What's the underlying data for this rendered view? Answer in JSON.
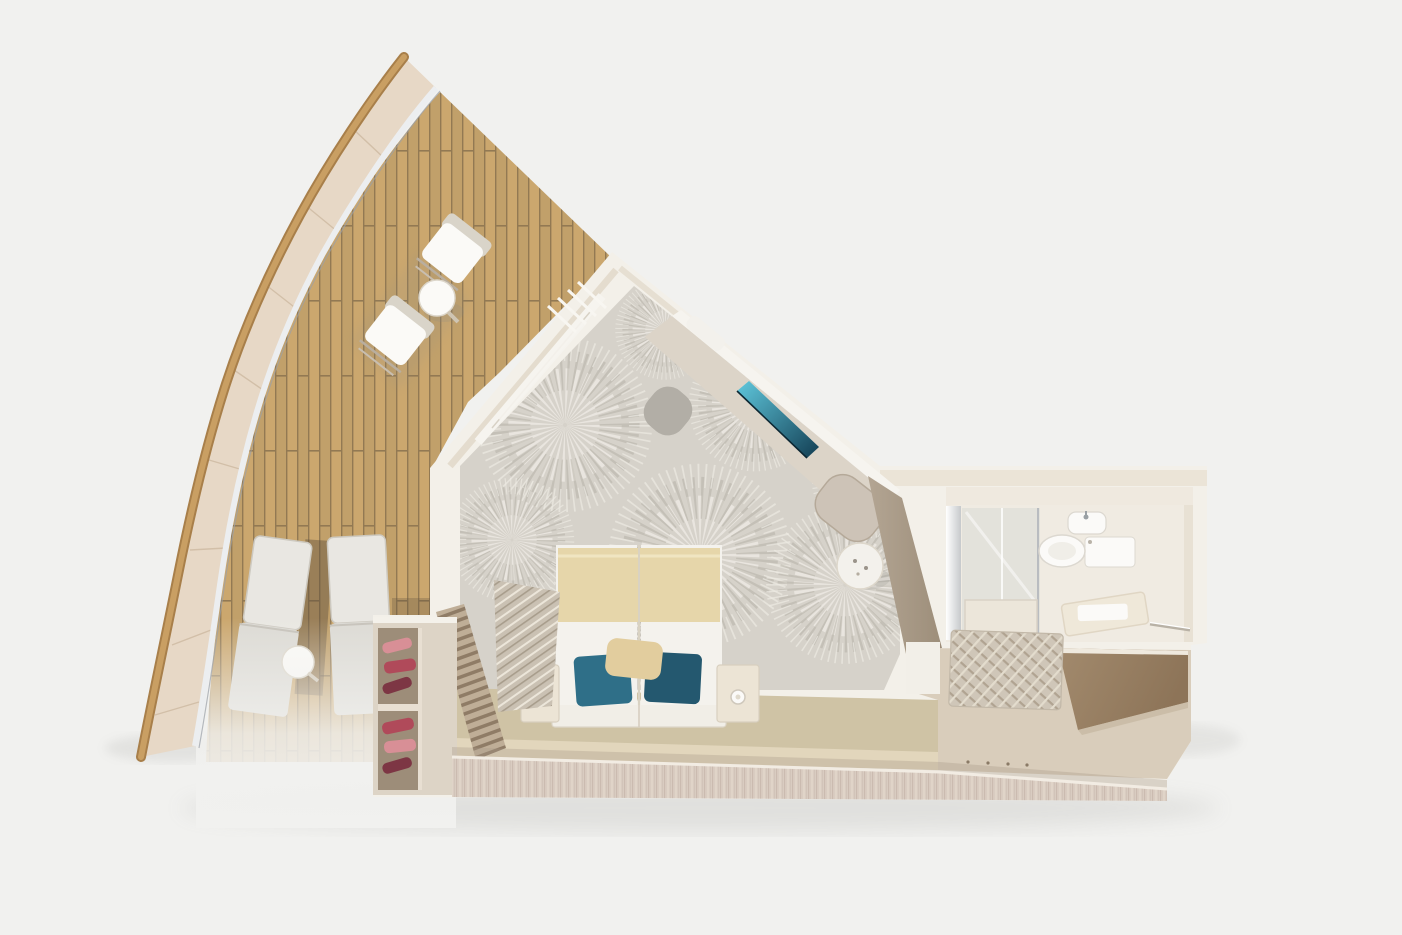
{
  "scene": {
    "type": "3d-cutaway-floor-plan-render",
    "subject": "cruise-ship-bow-suite-top-view",
    "areas": [
      {
        "name": "balcony",
        "objects": [
          "curved-hull",
          "glass-railing",
          "teak-deck",
          "deck-chair",
          "deck-chair",
          "round-table",
          "sun-lounger",
          "sun-lounger",
          "side-table"
        ]
      },
      {
        "name": "bedroom",
        "objects": [
          "patterned-carpet",
          "twin-beds",
          "teal-pillows",
          "nightstand-left",
          "nightstand-right",
          "table-lamps",
          "desk-console",
          "wall-tv",
          "desk-chair",
          "lounge-chair",
          "vanity-stool",
          "curtains",
          "balcony-door",
          "wardrobe-with-shoes",
          "louver-bench",
          "textured-wall"
        ]
      },
      {
        "name": "bathroom",
        "objects": [
          "shower-glass",
          "mirror",
          "toilet",
          "sink",
          "bath-mat",
          "towel-rail"
        ]
      },
      {
        "name": "corridor",
        "objects": [
          "entry-floor",
          "dark-entry-wall",
          "woven-rug",
          "floor-markers"
        ]
      }
    ]
  },
  "colors": {
    "background": "#f1f1ef",
    "shadow": "#8a8a86",
    "hull_rail": "#c99f63",
    "hull_rail_dark": "#a87f4a",
    "hull_band": "#e7d8c6",
    "hull_seam": "#cdb9a1",
    "railing": "#eceef0",
    "railing_edge": "#9aa0a8",
    "deck_plank": "#c7a164",
    "deck_gap": "#8a6f46",
    "wall_top": "#f3f0e9",
    "wall_face": "#ddd2c0",
    "taupe_wall": "#b3a593",
    "carpet_base": "#d6d2ca",
    "carpet_light": "#edeae3",
    "carpet_dark": "#b0aa9f",
    "blanket": "#e6d6aa",
    "duvet": "#f4f2ed",
    "pillow_teal": "#2f6f88",
    "pillow_teal_dark": "#24586f",
    "pillow_beige": "#e2cd9e",
    "headboard": "#f1eee7",
    "nightstand": "#ece4d5",
    "platform": "#cfc3a5",
    "platform_frame": "#e3d8bf",
    "bottom_wall": "#d9ccc1",
    "bottom_wall_grain": "#c3b3a7",
    "wardrobe": "#ddd4c6",
    "wardrobe_back": "#9d8d79",
    "shoe_red": "#b04a5a",
    "shoe_pink": "#d88f96",
    "shoe_dark": "#7d3644",
    "louver_light": "#bfae97",
    "louver_dark": "#8f7c66",
    "texture_wall": "#cac1b3",
    "desk": "#dcd4c8",
    "desk_edge": "#f6f4ef",
    "tv_teal": "#5fc8dd",
    "tv_dark": "#123d52",
    "chair_gray": "#b2aea6",
    "chair_beige": "#cdc3b7",
    "stool": "#f3f1ec",
    "bathroom_floor": "#f0ebe2",
    "bathroom_wall": "#efe9df",
    "glass": "#d9dad6",
    "fixture_white": "#fbfaf8",
    "fixture_line": "#d8d2c6",
    "corridor_floor": "#d9cdbb",
    "corridor_wall_dark": "#a28a6d",
    "corridor_wall_darker": "#8d7458",
    "rug": "#cfc6b8",
    "rug_dark": "#b0a391",
    "lounger": "#dcdad4",
    "lounger_light": "#e9e7e2",
    "lounger_frame": "#c6c2ba",
    "table_white": "#fbfaf7",
    "deck_shadow": "#5f4f3d",
    "mat": "#efe8d9"
  }
}
